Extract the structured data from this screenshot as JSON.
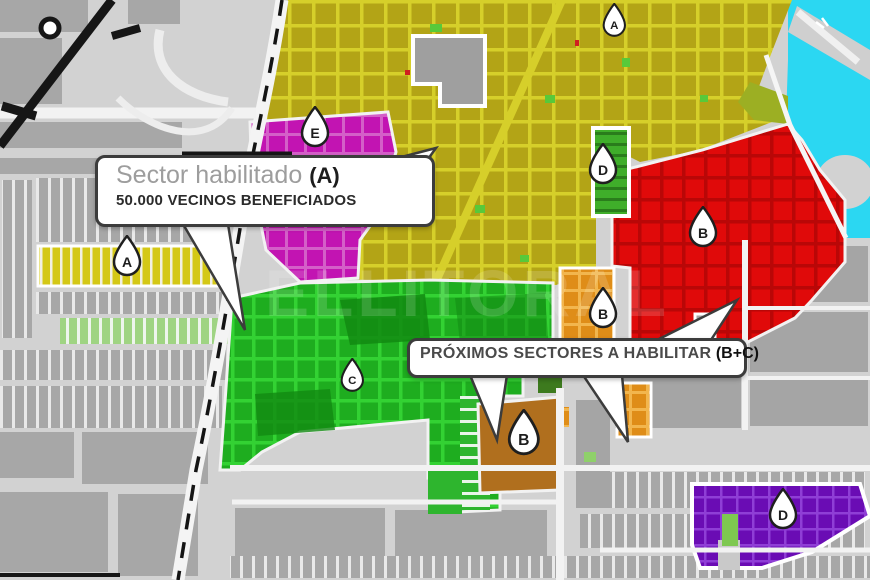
{
  "title": "Mapa de sectores habilitados",
  "watermark": "ELLITORAL",
  "colors": {
    "background": "#d2d2d2",
    "blocks_gray": "#a7a7a7",
    "road_white": "#ffffff",
    "railway_black": "#161616",
    "sector_a_yellow": "#b3a416",
    "sector_a_grid": "#d6cf2a",
    "sector_a_strip": "#d4c816",
    "sector_b_red": "#e00a0a",
    "sector_b_orange": "#df8d18",
    "sector_b_brown": "#b06f1e",
    "sector_c_green": "#1ead1f",
    "sector_c_grid": "#33d233",
    "sector_d_strip_green": "#3fae2a",
    "sector_d_purple": "#6a0cb4",
    "sector_e_magenta": "#c214b2",
    "water_cyan": "#2bd7f2",
    "park_green": "#58c93a",
    "pin_fill": "#ffffff",
    "pin_stroke": "#1f1f1f"
  },
  "markers": [
    {
      "id": "pin-a-top",
      "label": "A"
    },
    {
      "id": "pin-e",
      "label": "E"
    },
    {
      "id": "pin-d-top",
      "label": "D"
    },
    {
      "id": "pin-b-red",
      "label": "B"
    },
    {
      "id": "pin-b-orange",
      "label": "B"
    },
    {
      "id": "pin-c",
      "label": "C"
    },
    {
      "id": "pin-b-brown",
      "label": "B"
    },
    {
      "id": "pin-d-purple",
      "label": "D"
    },
    {
      "id": "pin-a-left",
      "label": "A"
    }
  ],
  "callouts": {
    "habilitado": {
      "title": "Sector habilitado",
      "sector": "(A)",
      "subtitle": "50.000 VECINOS BENEFICIADOS"
    },
    "proximos": {
      "text": "PRÓXIMOS SECTORES A HABILITAR",
      "sector": "(B+C)"
    }
  }
}
